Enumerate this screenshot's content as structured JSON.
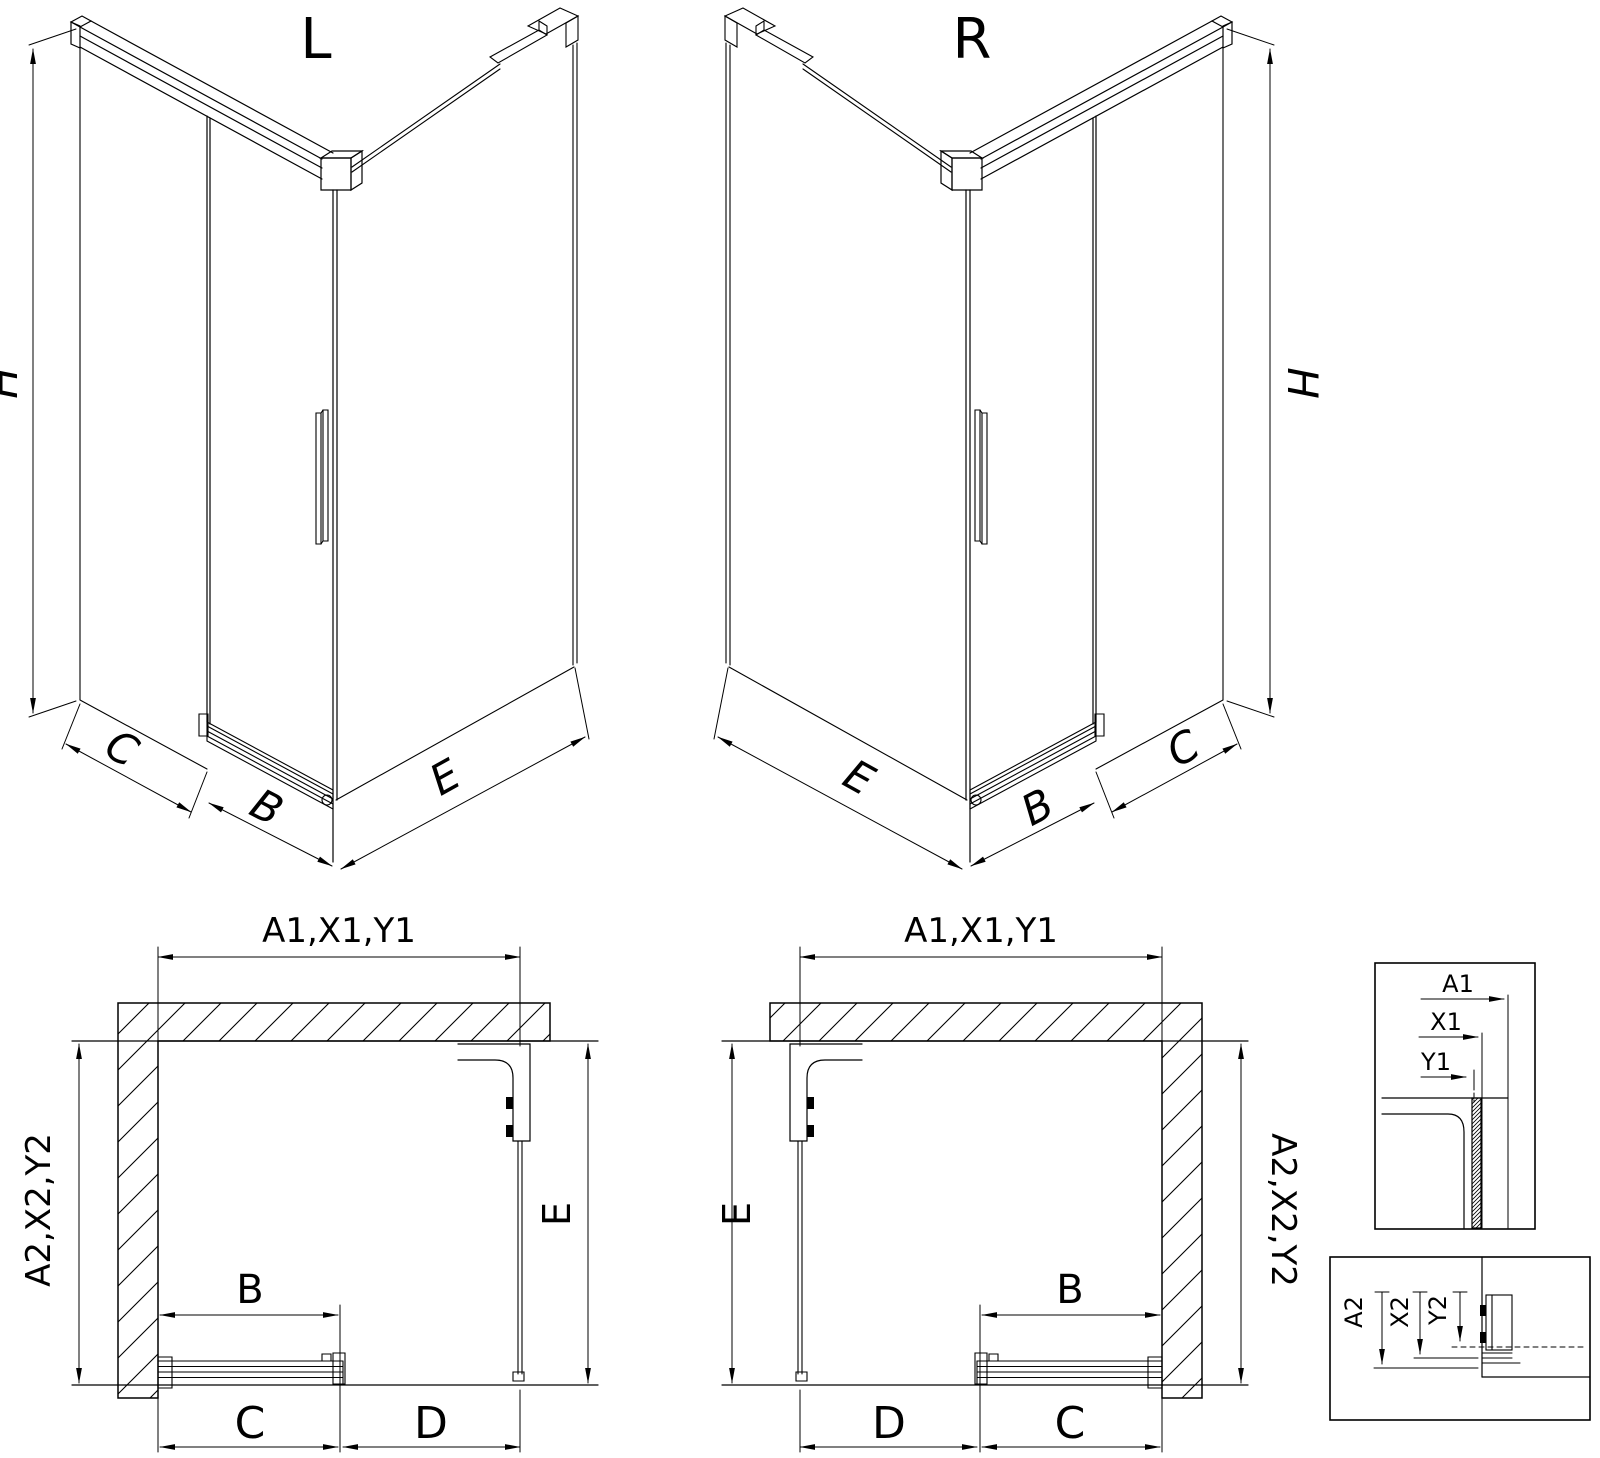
{
  "colors": {
    "line": "#000000",
    "background": "#ffffff"
  },
  "views": {
    "iso_left": {
      "label": "L",
      "dim_height": "H",
      "dim_side": "C",
      "dim_door": "B",
      "dim_front": "E"
    },
    "iso_right": {
      "label": "R",
      "dim_height": "H",
      "dim_side": "C",
      "dim_door": "B",
      "dim_front": "E"
    },
    "plan_left": {
      "dim_top": "A1,X1,Y1",
      "dim_left": "A2,X2,Y2",
      "dim_inner_depth": "E",
      "dim_door": "B",
      "dim_bottom_inner": "C",
      "dim_bottom_outer": "D"
    },
    "plan_right": {
      "dim_top": "A1,X1,Y1",
      "dim_right": "A2,X2,Y2",
      "dim_inner_depth": "E",
      "dim_door": "B",
      "dim_bottom_outer": "D",
      "dim_bottom_inner": "C"
    },
    "detail_top": {
      "dim_a1": "A1",
      "dim_x1": "X1",
      "dim_y1": "Y1"
    },
    "detail_bottom": {
      "dim_a2": "A2",
      "dim_x2": "X2",
      "dim_y2": "Y2"
    }
  }
}
